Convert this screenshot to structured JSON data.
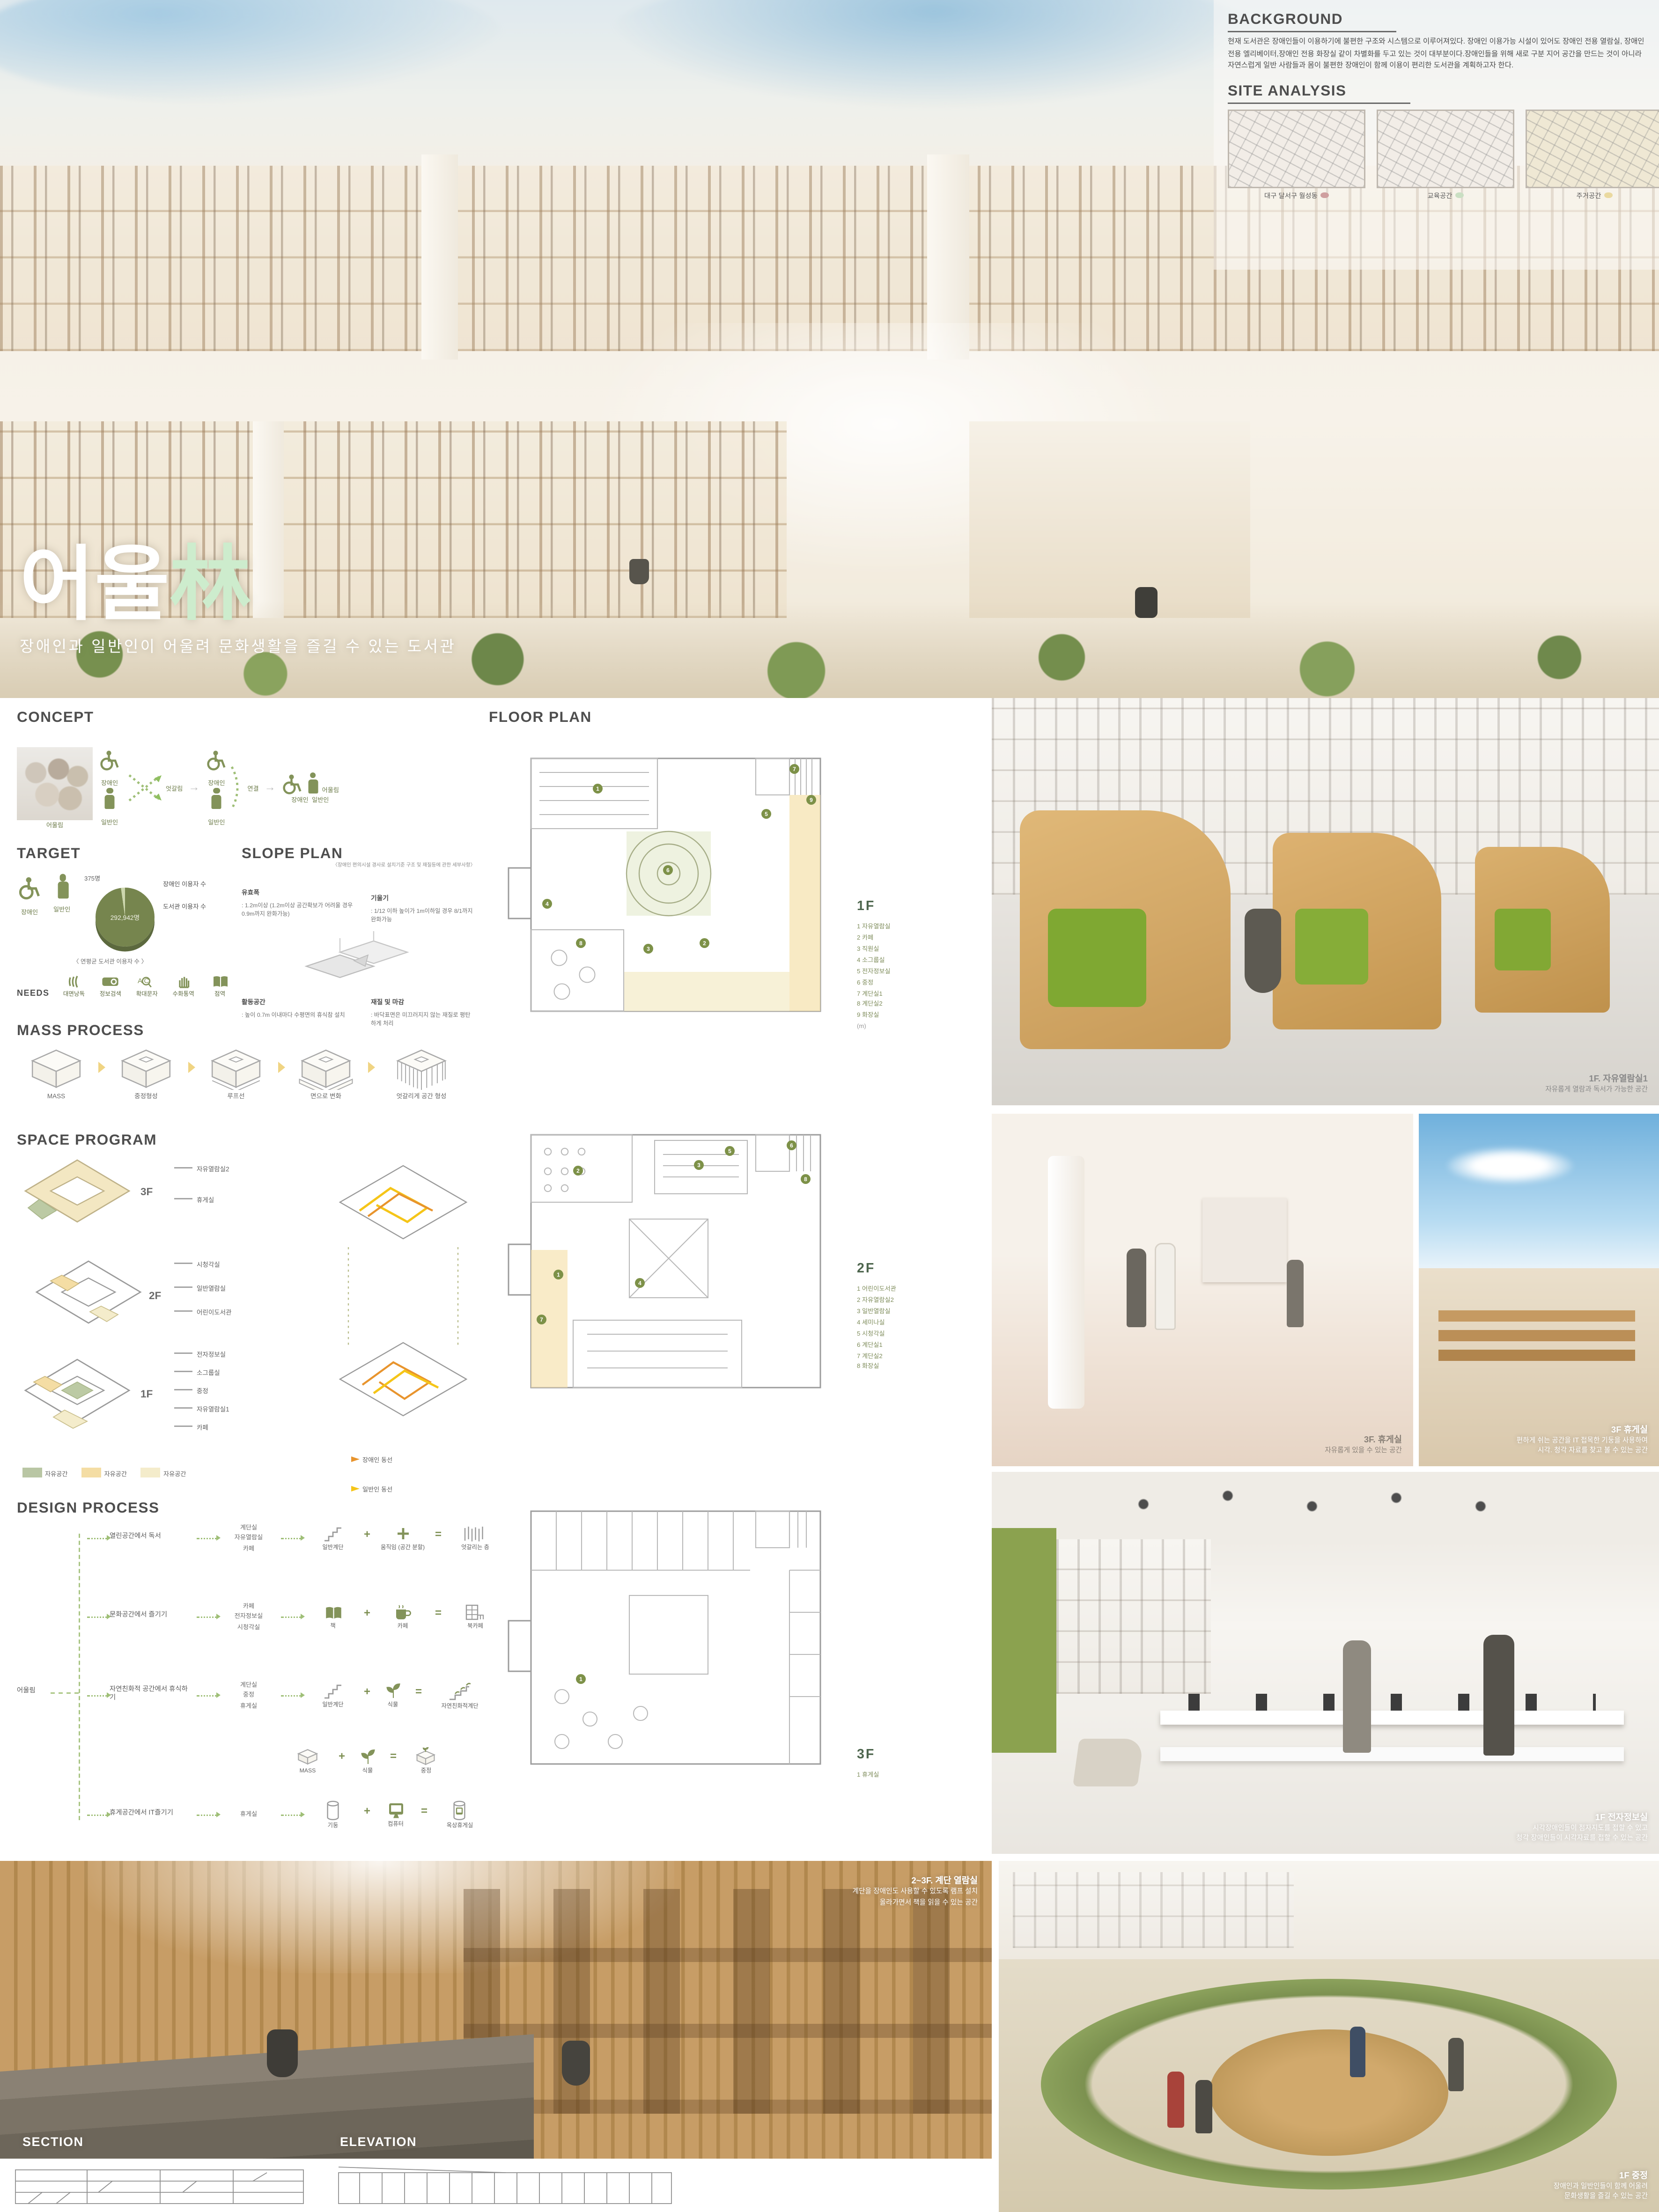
{
  "title_block": {
    "name_kr": "어울",
    "name_hanja": "林",
    "subtitle": "장애인과 일반인이 어울려 문화생활을 즐길 수 있는 도서관"
  },
  "background": {
    "title": "BACKGROUND",
    "body": "현재 도서관은 장애인들이 이용하기에 불편한 구조와 시스템으로 이루어져있다. 장애인 이용가능 시설이 있어도 장애인 전용 열람실, 장애인 전용 엘리베이터,장애인 전용 화장실 같이 차별화를 두고 있는 것이 대부분이다.장애인들을 위해 새로 구분 지어 공간을 만드는 것이 아니라 자연스럽게 일반 사람들과 몸이 불편한 장애인이 함께 이용이 편리한 도서관을 계획하고자 한다."
  },
  "site_analysis": {
    "title": "SITE ANALYSIS",
    "maps": [
      {
        "caption": "대구 달서구 월성동",
        "dot_color": "#cf9f9f"
      },
      {
        "caption": "교육공간",
        "dot_color": "#cadfc3"
      },
      {
        "caption": "주거공간",
        "dot_color": "#ead9a0"
      }
    ]
  },
  "concept": {
    "title": "CONCEPT",
    "photo_caption": "어울림",
    "disabled_label": "장애인",
    "general_label": "일반인",
    "cross_label": "엇갈림",
    "link_label": "연결",
    "result_label": "어울림",
    "result_sub1": "장애인",
    "result_sub2": "일반인"
  },
  "target": {
    "title": "TARGET",
    "disabled_label": "장애인",
    "general_label": "일반인",
    "pie": {
      "small_value": "375명",
      "small_label": "장애인 이용자 수",
      "big_value": "292,942명",
      "big_label": "도서관 이용자 수",
      "caption": "〈 연평균 도서관 이용자 수 〉"
    },
    "needs_label": "NEEDS",
    "needs": [
      "대면낭독",
      "정보검색",
      "확대문자",
      "수화통역",
      "점역"
    ]
  },
  "slope_plan": {
    "title": "SLOPE PLAN",
    "note": "〈장애인 편의시설 경사로 설치기준 구조 및 재질등에 관한 세부사항〉",
    "items": [
      {
        "term": "유효폭",
        "desc": ": 1.2m이상 (1.2m이상 공간확보가 어려울 경우 0.9m까지 완화가능)"
      },
      {
        "term": "기울기",
        "desc": ": 1/12 이하 높이가 1m이하일 경우 8/1까지 완화가능"
      },
      {
        "term": "활동공간",
        "desc": ": 높이 0.7m 이내마다 수평면의 휴식참 설치"
      },
      {
        "term": "재질 및 마감",
        "desc": ": 바닥표면은 미끄러지지 않는 재질로 평탄하게 처리"
      }
    ]
  },
  "mass_process": {
    "title": "MASS PROCESS",
    "steps": [
      "MASS",
      "중정형성",
      "루프선",
      "면으로 변화",
      "엇갈리게 공간 형성"
    ]
  },
  "space_program": {
    "title": "SPACE PROGRAM",
    "floors": [
      {
        "label": "3F",
        "rooms": [
          "자유열람실2",
          "휴게실"
        ]
      },
      {
        "label": "2F",
        "rooms": [
          "시청각실",
          "일반열람실",
          "어린이도서관"
        ]
      },
      {
        "label": "1F",
        "rooms": [
          "전자정보실",
          "소그룹실",
          "중정",
          "자유열람실1",
          "카페"
        ]
      }
    ],
    "area_legend": [
      {
        "label": "자유공간",
        "color": "#b9c6a4"
      },
      {
        "label": "자유공간",
        "color": "#f4dda4"
      },
      {
        "label": "자유공간",
        "color": "#f4eccb"
      }
    ],
    "flow_legend": [
      {
        "label": "장애인 동선",
        "color": "#e8942d"
      },
      {
        "label": "일반인 동선",
        "color": "#f5c518"
      }
    ]
  },
  "design_process": {
    "title": "DESIGN PROCESS",
    "root": "어울림",
    "rows": [
      {
        "activity": "열린공간에서 독서",
        "spaces": [
          "계단실",
          "자유열람실",
          "카페"
        ],
        "a": "일반계단",
        "b": "움직임 (공간 분할)",
        "result": "엇갈리는 층"
      },
      {
        "activity": "문화공간에서 즐기기",
        "spaces": [
          "카페",
          "전자정보실",
          "시청각실"
        ],
        "a": "책",
        "b": "카페",
        "result": "북카페"
      },
      {
        "activity": "자연친화적 공간에서 휴식하기",
        "spaces": [
          "계단실",
          "중정",
          "휴게실"
        ],
        "a": "일반계단",
        "b": "식물",
        "result": "자연친화적계단"
      },
      {
        "activity": "",
        "spaces": [],
        "a": "MASS",
        "b": "식물",
        "result": "중정"
      },
      {
        "activity": "휴게공간에서 IT즐기기",
        "spaces": [
          "휴게실"
        ],
        "a": "기둥",
        "b": "컴퓨터",
        "result": "옥상휴게실"
      }
    ]
  },
  "floor_plan": {
    "title": "FLOOR PLAN",
    "floors": [
      {
        "label": "1F",
        "legend": [
          "1 자유열람실",
          "2 카페",
          "3 직원실",
          "4 소그룹실",
          "5 전자정보실",
          "6 중정",
          "7 계단실1",
          "8 계단실2",
          "9 화장실"
        ],
        "scale": "(m)",
        "markers": [
          "1",
          "2",
          "3",
          "4",
          "5",
          "6",
          "7",
          "8",
          "9"
        ]
      },
      {
        "label": "2F",
        "legend": [
          "1 어린이도서관",
          "2 자유열람실2",
          "3 일반열람실",
          "4 세미나실",
          "5 시청각실",
          "6 계단실1",
          "7 계단실2",
          "8 화장실"
        ],
        "scale": "",
        "markers": [
          "1",
          "2",
          "3",
          "4",
          "5",
          "6",
          "7",
          "8"
        ]
      },
      {
        "label": "3F",
        "legend": [
          "1 휴게실"
        ],
        "scale": "",
        "markers": [
          "1"
        ]
      }
    ]
  },
  "renders": {
    "r1": {
      "title": "1F. 자유열람실1",
      "line1": "자유롭게 열람과 독서가 가능한 공간",
      "line2": ""
    },
    "r2": {
      "title": "3F. 휴게실",
      "line1": "자유롭게 있을 수 있는 공간",
      "line2": ""
    },
    "r3": {
      "title": "3F 휴게실",
      "line1": "편하게 쉬는 공간을 IT 접목한 기둥을 사용하여",
      "line2": "시각. 청각 자료를 찾고 볼 수 있는 공간"
    },
    "r4": {
      "title": "1F 전자정보실",
      "line1": "시각장애인들이 점자지도를 접할 수 있고",
      "line2": "청각 장애인들이 시각자료를 접할 수 있는 공간"
    },
    "r5": {
      "title": "2~3F. 계단 열람실",
      "line1": "계단을 장애인도 사용할 수 있도록 램프 설치",
      "line2": "올라가면서 책을 읽을 수 있는 공간"
    },
    "r6": {
      "title": "1F 중정",
      "line1": "장애인과 일반인들이 함께 어울려",
      "line2": "문화생활을 즐길 수 있는 공간"
    }
  },
  "drawings": {
    "section_title": "SECTION",
    "elevation_title": "ELEVATION"
  }
}
